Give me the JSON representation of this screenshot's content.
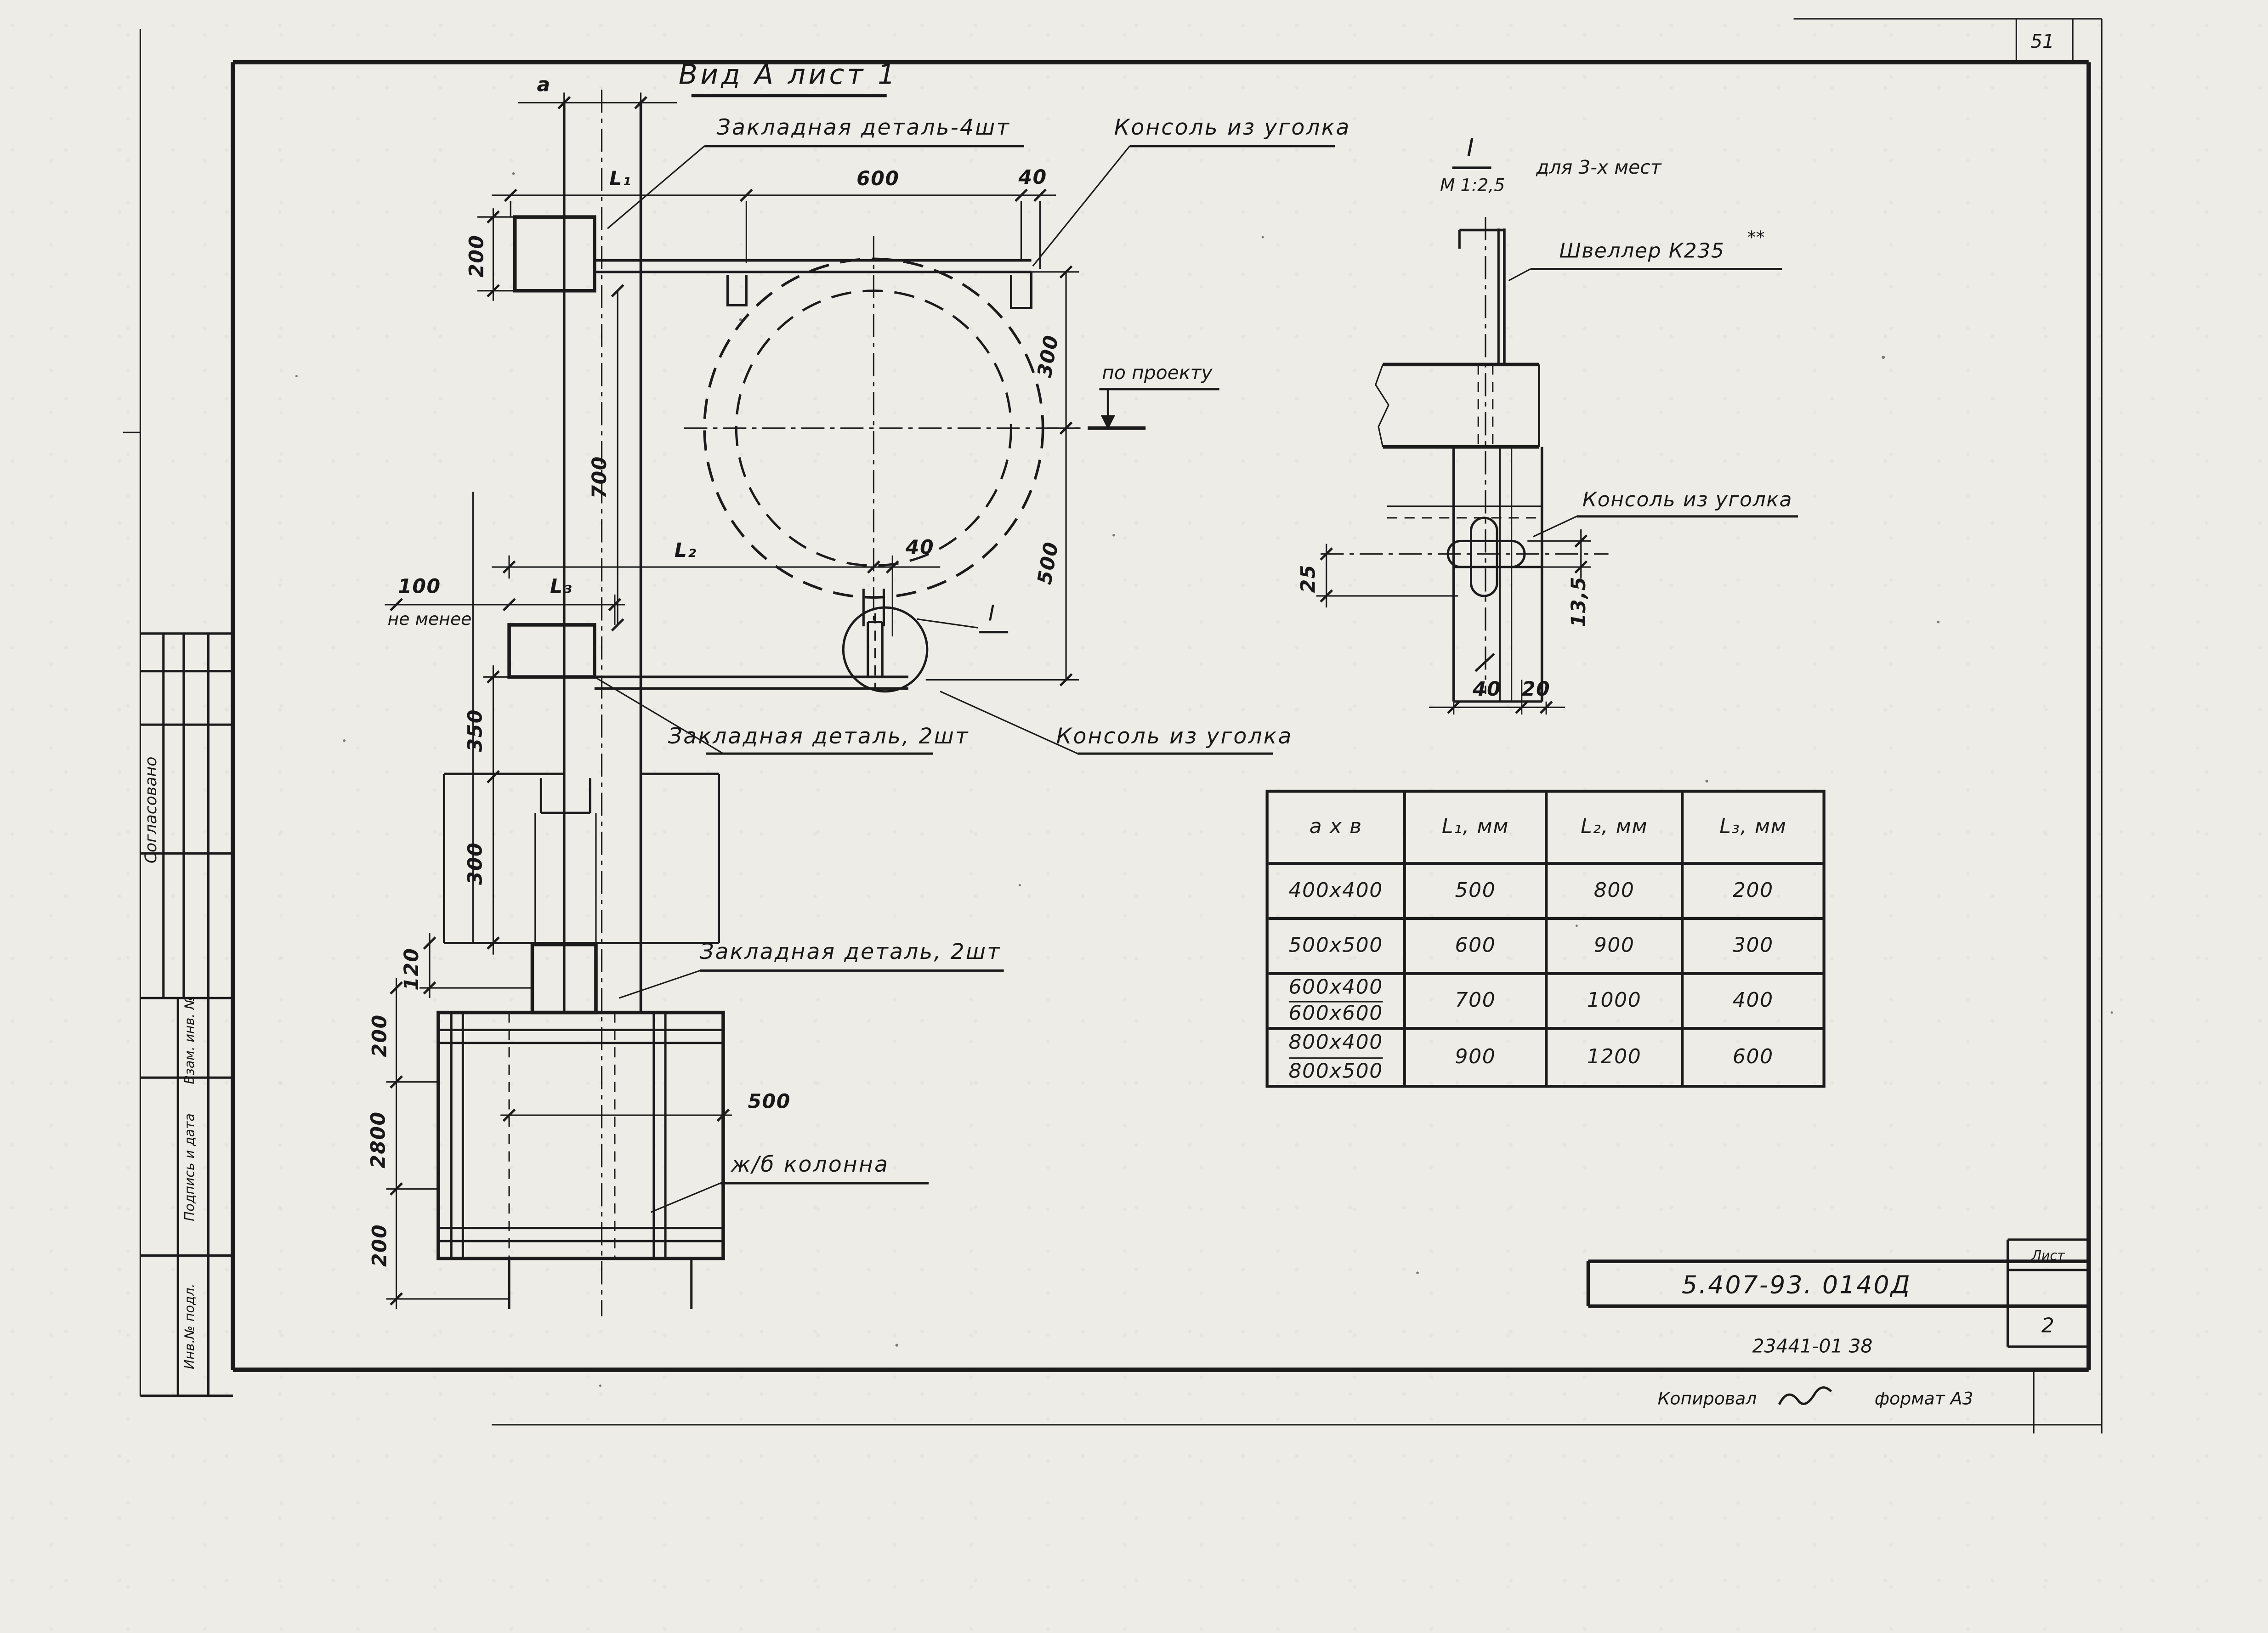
{
  "sheet": {
    "corner_number": "51",
    "paper_color": "#edece7",
    "ink_color": "#1b1b1b"
  },
  "main_view": {
    "title": "Вид А лист 1",
    "labels": {
      "embedded_plate_4": "Закладная деталь-4шт",
      "console_top": "Консоль из уголка",
      "by_project": "по проекту",
      "embedded_plate_2a": "Закладная деталь, 2шт",
      "console_mid": "Консоль из уголка",
      "embedded_plate_2b": "Закладная деталь, 2шт",
      "column": "ж/б колонна",
      "detail_mark": "I"
    },
    "dims": {
      "a": "a",
      "l1": "L₁",
      "d600": "600",
      "d40_top": "40",
      "d200_plate": "200",
      "d700": "700",
      "d300_tank": "300",
      "d500_tank": "500",
      "l2": "L₂",
      "d40_mid": "40",
      "d100": "100",
      "not_less": "не менее",
      "l3": "L₃",
      "d350": "350",
      "d300_col": "300",
      "d120": "120",
      "d200_upper": "200",
      "d2800": "2800",
      "d200_lower": "200",
      "d500_col": "500"
    }
  },
  "detail_view": {
    "mark": "I",
    "scale": "М 1:2,5",
    "note": "для 3-х мест",
    "labels": {
      "channel": "Швеллер К235",
      "channel_stars": "**",
      "console": "Консоль из уголка"
    },
    "dims": {
      "d25": "25",
      "d13_5": "13,5",
      "d40": "40",
      "d20": "20"
    }
  },
  "table": {
    "headers": [
      "а х в",
      "L₁, мм",
      "L₂, мм",
      "L₃, мм"
    ],
    "rows": [
      {
        "size": "400х400",
        "l1": "500",
        "l2": "800",
        "l3": "200"
      },
      {
        "size": "500х500",
        "l1": "600",
        "l2": "900",
        "l3": "300"
      },
      {
        "size_top": "600х400",
        "size_bottom": "600х600",
        "l1": "700",
        "l2": "1000",
        "l3": "400"
      },
      {
        "size_top": "800х400",
        "size_bottom": "800х500",
        "l1": "900",
        "l2": "1200",
        "l3": "600"
      }
    ]
  },
  "title_block": {
    "doc_number": "5.407-93. 0140Д",
    "sheet_label": "Лист",
    "sheet_number": "2",
    "stamp_code": "23441-01   38",
    "copied_label": "Копировал",
    "format_label": "формат А3"
  },
  "side_stamp": {
    "agreed": "Согласовано",
    "vzam": "Взам. инв. №",
    "podpis": "Подпись и дата",
    "inv": "Инв.№ подл."
  }
}
